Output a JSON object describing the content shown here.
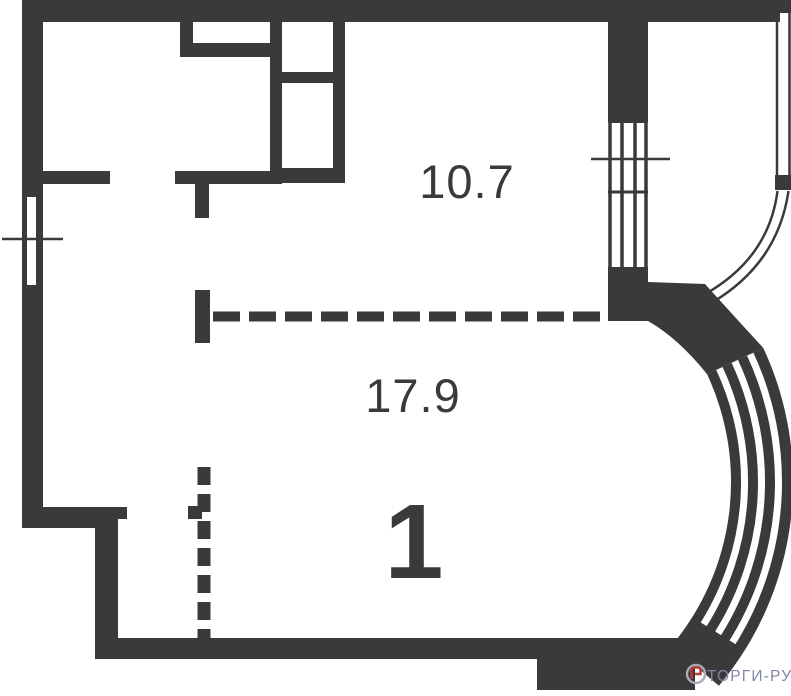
{
  "plan": {
    "apartment_number": "1",
    "rooms": [
      {
        "name": "upper-room",
        "area": "10.7"
      },
      {
        "name": "lower-room",
        "area": "17.9"
      }
    ]
  },
  "watermark": {
    "brand": "ТОРГИ-РУ"
  },
  "colors": {
    "wall": "#3a3a3a",
    "background": "#ffffff",
    "watermark_text": "#8186a6",
    "logo_ring": "#a6adb5",
    "logo_accent": "#bf3a36"
  }
}
